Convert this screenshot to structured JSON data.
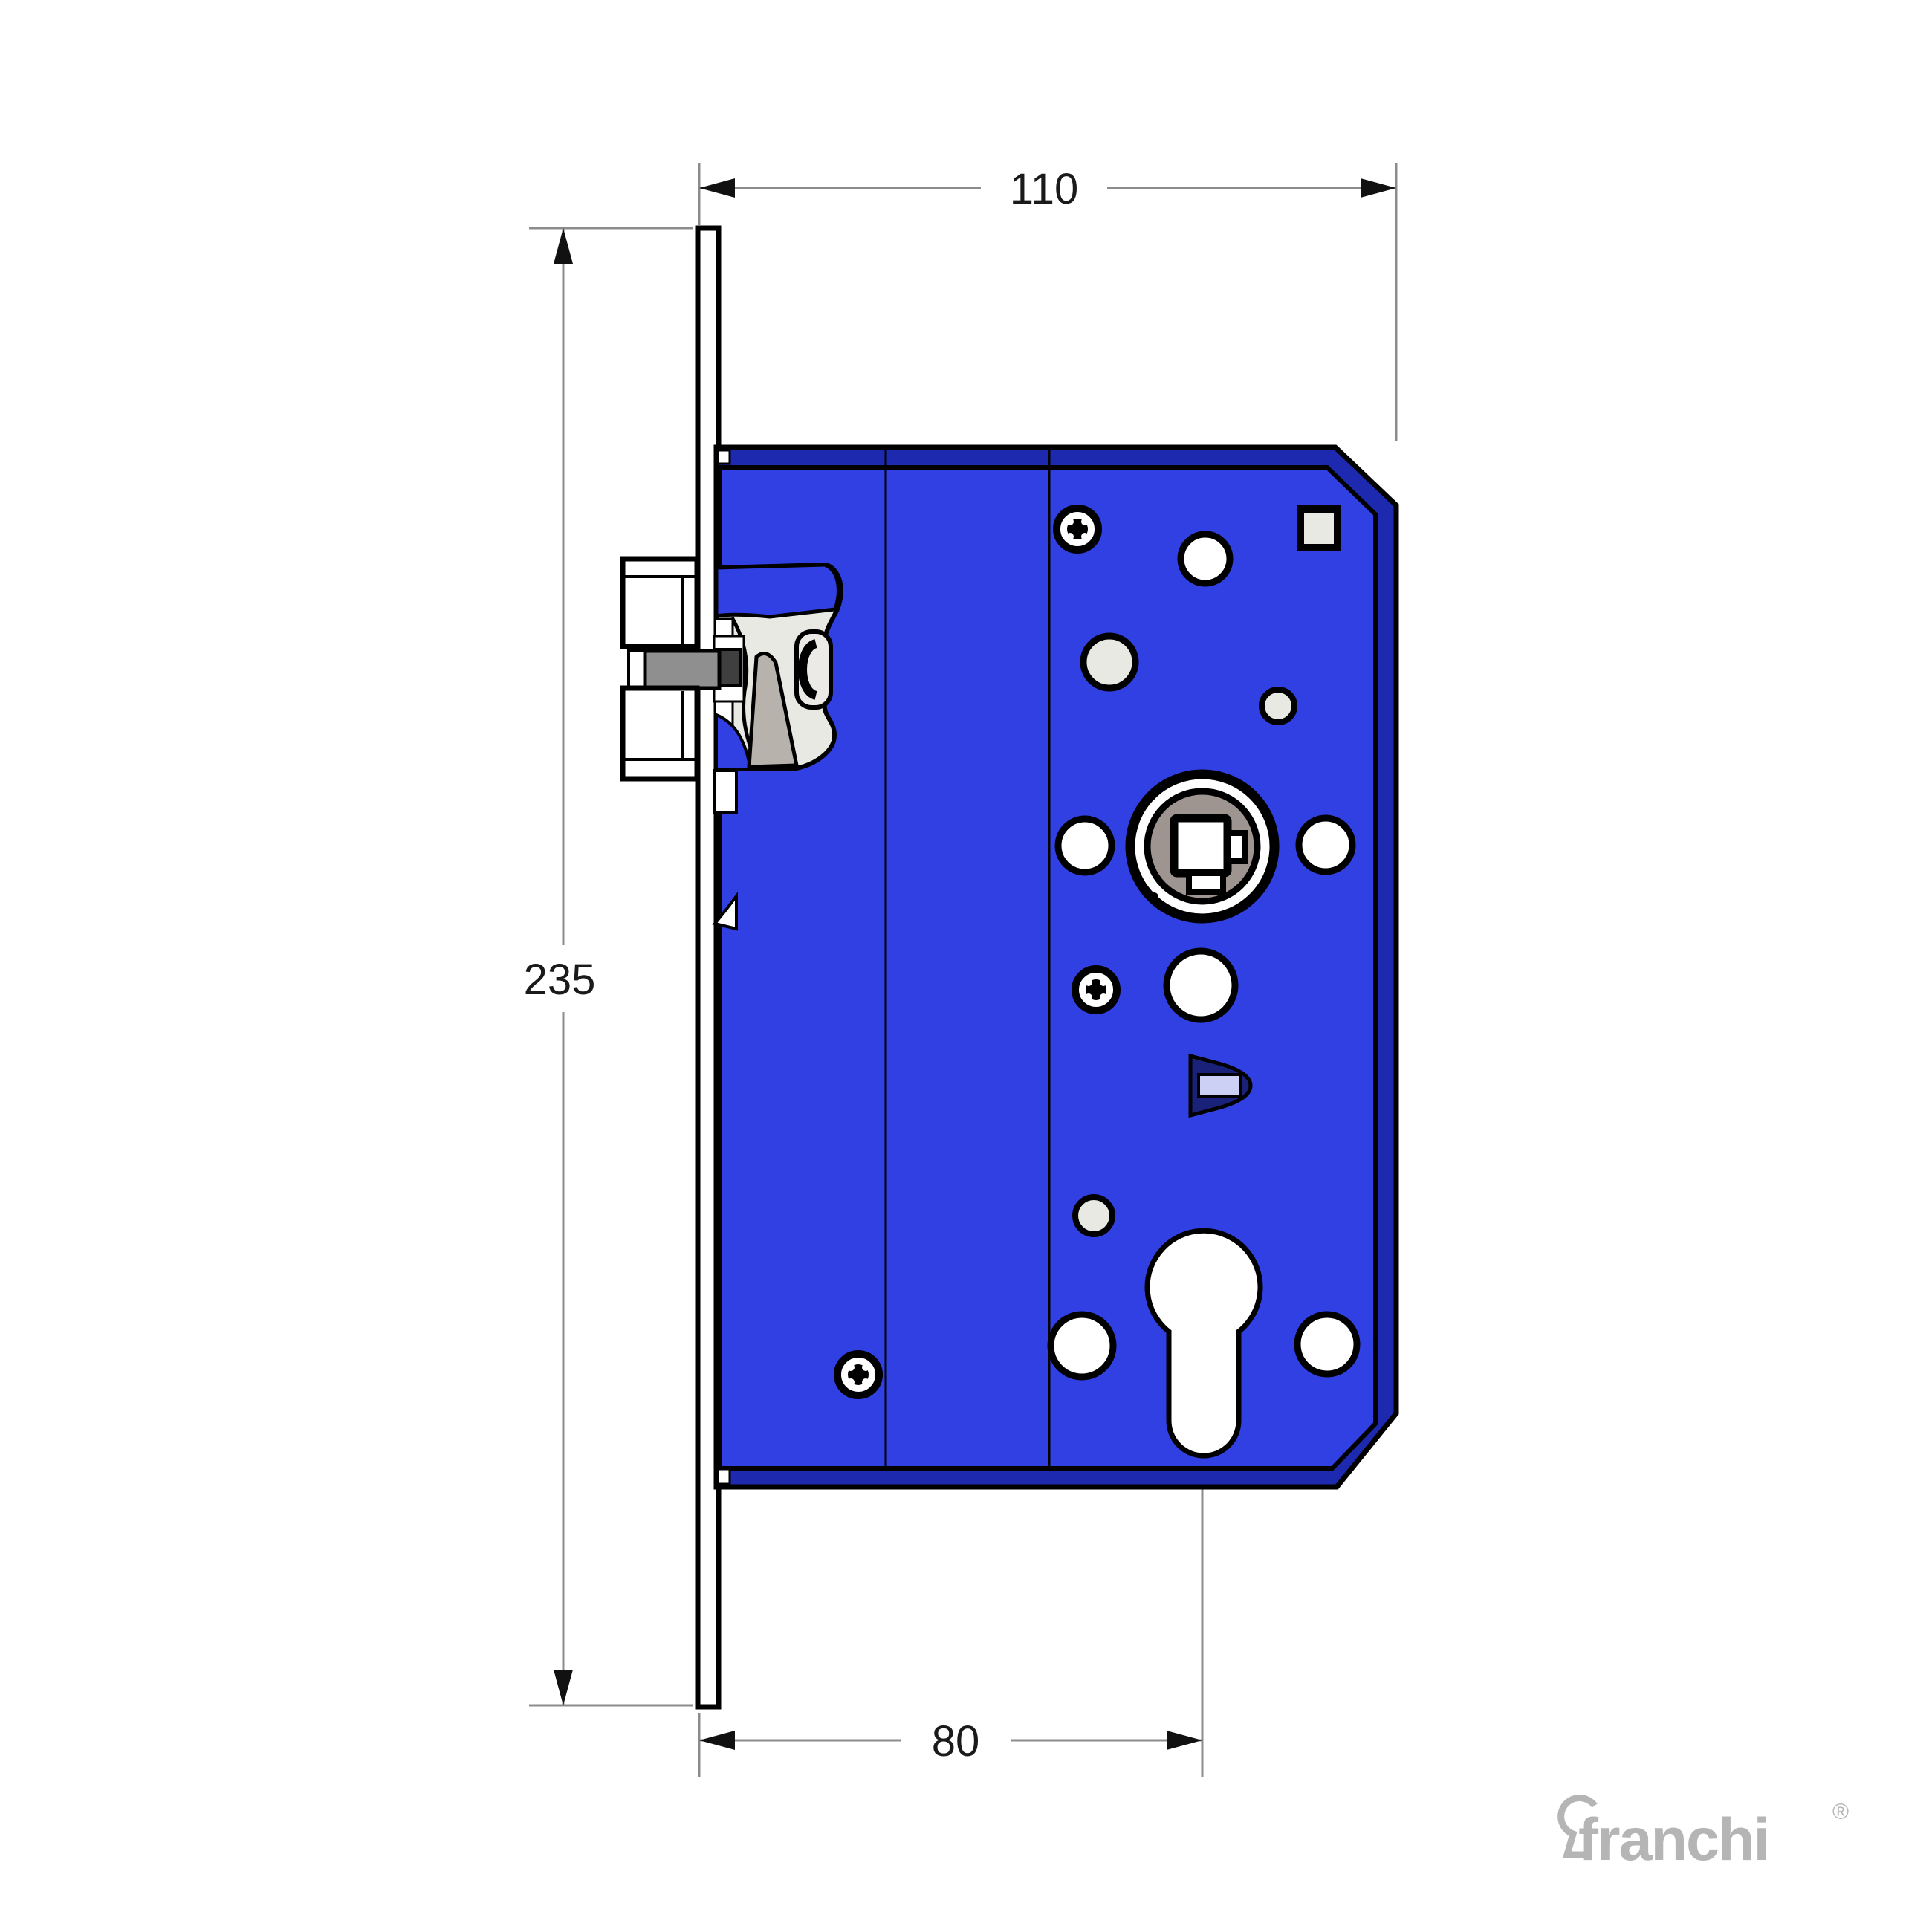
{
  "drawing": {
    "type": "mortise-lock-technical-drawing",
    "dimensions": {
      "case_width": {
        "label": "110"
      },
      "total_height": {
        "label": "235"
      },
      "backset": {
        "label": "80"
      }
    },
    "logo": {
      "brand": "franchi",
      "registered_mark": "®",
      "icon": "keyhole-icon"
    }
  },
  "colors": {
    "body_blue": "#3140e2",
    "bevel_blue": "#1d2ab0",
    "hole_offwhite": "#e9e9e3",
    "follower_gray": "#9e9490",
    "latch_gray": "#8f8f8f",
    "dark_gray": "#3f3f3f",
    "wedge_gray": "#b7b3ac",
    "lug_navy": "#192179",
    "lug_light": "#ccd0f4",
    "logo_gray": "#b5b5b5",
    "dim_gray": "#8c8c8c"
  }
}
